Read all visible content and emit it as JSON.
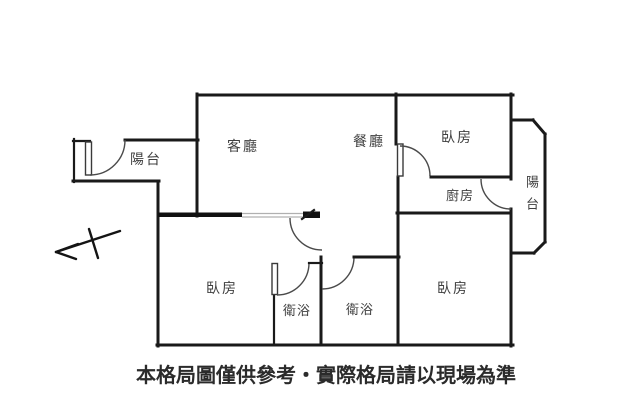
{
  "plan": {
    "rooms": {
      "balcony_left": "陽台",
      "living_room": "客廳",
      "dining_room": "餐廳",
      "bedroom_top": "臥房",
      "balcony_right": "陽台",
      "kitchen": "廚房",
      "bedroom_left": "臥房",
      "bathroom_left": "衛浴",
      "bathroom_right": "衛浴",
      "bedroom_right": "臥房"
    },
    "disclaimer": "本格局圖僅供參考‧實際格局請以現場為準",
    "colors": {
      "wall": "#1a1a1a",
      "label": "#3f3f3f",
      "disclaimer_text": "#2b2b2b",
      "background": "#ffffff",
      "sliding_track": "#b0b0b0"
    },
    "icons": {
      "north_arrow": "north-arrow-icon"
    }
  }
}
